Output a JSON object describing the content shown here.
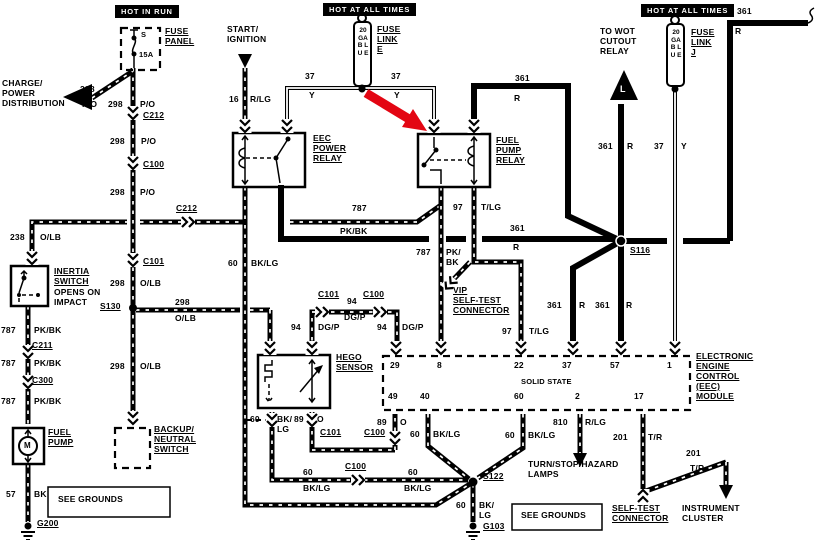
{
  "headers": {
    "hot_in_run": "HOT IN RUN",
    "hot_at_all_times_mid": "HOT AT ALL TIMES",
    "hot_at_all_times_right": "HOT AT ALL TIMES"
  },
  "components": {
    "fuse_panel": {
      "label": "FUSE\nPANEL",
      "fuse_id": "S",
      "rating": "15A"
    },
    "charge_power": "CHARGE/\nPOWER\nDISTRIBUTION",
    "start_ignition": "START/\nIGNITION",
    "fuse_link_e": {
      "gauge": "20 GA B L U E",
      "label": "FUSE\nLINK\nE"
    },
    "fuse_link_j": {
      "gauge": "20 GA B L U E",
      "label": "FUSE\nLINK\nJ"
    },
    "wot": {
      "label": "TO WOT\nCUTOUT\nRELAY",
      "arrow_letter": "L"
    },
    "eec_power_relay": "EEC\nPOWER\nRELAY",
    "fuel_pump_relay": "FUEL\nPUMP\nRELAY",
    "inertia_switch": {
      "name": "INERTIA\nSWITCH",
      "note": "OPENS ON\nIMPACT"
    },
    "fuel_pump": {
      "label": "FUEL\nPUMP",
      "motor": "M"
    },
    "backup_neutral": "BACKUP/\nNEUTRAL\nSWITCH",
    "hego": "HEGO\nSENSOR",
    "vip": "VIP\nSELF-TEST\nCONNECTOR",
    "eec_module": {
      "label": "ELECTRONIC\nENGINE\nCONTROL\n(EEC)\nMODULE",
      "solid_state": "SOLID STATE",
      "pins_top": [
        "29",
        "8",
        "22",
        "37",
        "57",
        "1"
      ],
      "pins_bottom": [
        "49",
        "40",
        "60",
        "2",
        "17"
      ]
    },
    "turn_stop": "TURN/STOP/HAZARD\nLAMPS",
    "self_test": "SELF-TEST\nCONNECTOR",
    "instrument_cluster": "INSTRUMENT\nCLUSTER",
    "see_grounds_1": "SEE GROUNDS",
    "see_grounds_2": "SEE GROUNDS"
  },
  "connectors": {
    "c212_main": "C212",
    "c100_main": "C100",
    "c101_main": "C101",
    "s130": "S130",
    "c212_h": "C212",
    "c211": "C211",
    "c300": "C300",
    "c101_top": "C101",
    "c100_top": "C100",
    "c101_bot": "C101",
    "c100_bot": "C100",
    "c100_low": "C100",
    "s116": "S116",
    "s122": "S122",
    "g200": "G200",
    "g103": "G103"
  },
  "wires": {
    "diag": {
      "n": "298",
      "c": "P/O"
    },
    "m1": {
      "n": "298",
      "c": "P/O"
    },
    "m2": {
      "n": "298",
      "c": "P/O"
    },
    "m3": {
      "n": "298",
      "c": "P/O"
    },
    "m4": {
      "n": "298",
      "c": "O/LB"
    },
    "s130r": {
      "n": "298",
      "c": "O/LB"
    },
    "m5": {
      "n": "298",
      "c": "O/LB"
    },
    "ign": {
      "n": "16",
      "c": "R/LG"
    },
    "fle_l": {
      "n": "37",
      "c": "Y"
    },
    "fle_r": {
      "n": "37",
      "c": "Y"
    },
    "flj": {
      "n": "37",
      "c": "Y"
    },
    "r361_fp": {
      "n": "361",
      "c": "R"
    },
    "r361_tr": {
      "n": "361",
      "c": "R"
    },
    "r361_wot": {
      "n": "361",
      "c": "R"
    },
    "r361_h": {
      "n": "361",
      "c": "R"
    },
    "r361_s1": {
      "n": "361",
      "c": "R"
    },
    "r361_s2": {
      "n": "361",
      "c": "R"
    },
    "il": {
      "n": "238",
      "c": "O/LB"
    },
    "p1": {
      "n": "787",
      "c": "PK/BK"
    },
    "p2": {
      "n": "787",
      "c": "PK/BK"
    },
    "p3": {
      "n": "787",
      "c": "PK/BK"
    },
    "ph": {
      "n": "787",
      "c": "PK/BK"
    },
    "pd": {
      "n": "787",
      "c": "PK/\nBK"
    },
    "t1": {
      "n": "97",
      "c": "T/LG"
    },
    "t2": {
      "n": "97",
      "c": "T/LG"
    },
    "g1": {
      "n": "60",
      "c": "BK/LG"
    },
    "h94a": {
      "n": "94",
      "c": "DG/P"
    },
    "h94b": {
      "n": "94",
      "c": "DG/P"
    },
    "h94c": {
      "n": "94",
      "c": "DG/P"
    },
    "ho": {
      "n": "60",
      "c": "BK/\nLG"
    },
    "ho2": {
      "n": "89",
      "c": "O"
    },
    "e49": {
      "n": "89",
      "c": "O"
    },
    "e40": {
      "n": "60",
      "c": "BK/LG"
    },
    "e60": {
      "n": "60",
      "c": "BK/LG"
    },
    "e2": {
      "n": "810",
      "c": "R/LG"
    },
    "e17": {
      "n": "201",
      "c": "T/R"
    },
    "ic": {
      "n": "201",
      "c": "T/R"
    },
    "glA": {
      "n": "60",
      "c": "BK/LG"
    },
    "glB": {
      "n": "60",
      "c": "BK/LG"
    },
    "g103w": {
      "n": "60",
      "c": "BK/\nLG"
    },
    "fpg": {
      "n": "57",
      "c": "BK"
    }
  },
  "colors": {
    "accent_arrow": "#e30613",
    "ink": "#000000",
    "paper": "#ffffff"
  }
}
